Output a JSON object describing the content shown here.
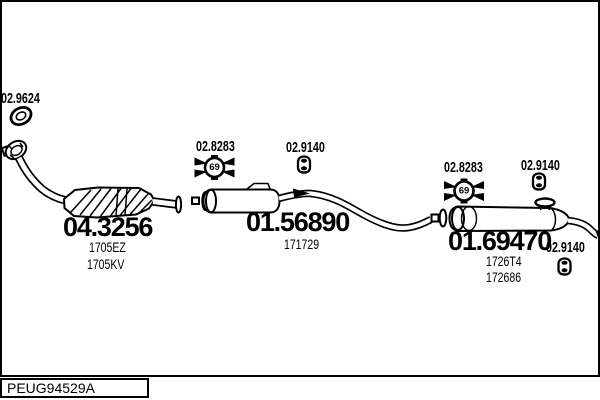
{
  "diagram": {
    "gasket": {
      "number": "02.9624"
    },
    "catalytic": {
      "number": "04.3256",
      "code1": "1705EZ",
      "code2": "1705KV"
    },
    "front_clamp": {
      "number": "02.8283",
      "size": "69"
    },
    "front_hanger": {
      "number": "02.9140"
    },
    "centre_silencer": {
      "number": "01.56890",
      "code1": "171729"
    },
    "rear_clamp": {
      "number": "02.8283",
      "size": "69"
    },
    "rear_hanger": {
      "number": "02.9140"
    },
    "rear_silencer": {
      "number": "01.69470",
      "code1": "1726T4",
      "code2": "172686"
    },
    "tail_hanger": {
      "number": "02.9140"
    },
    "footer": {
      "code": "PEUG94529A"
    },
    "colors": {
      "line": "#000000",
      "background": "#ffffff"
    }
  }
}
